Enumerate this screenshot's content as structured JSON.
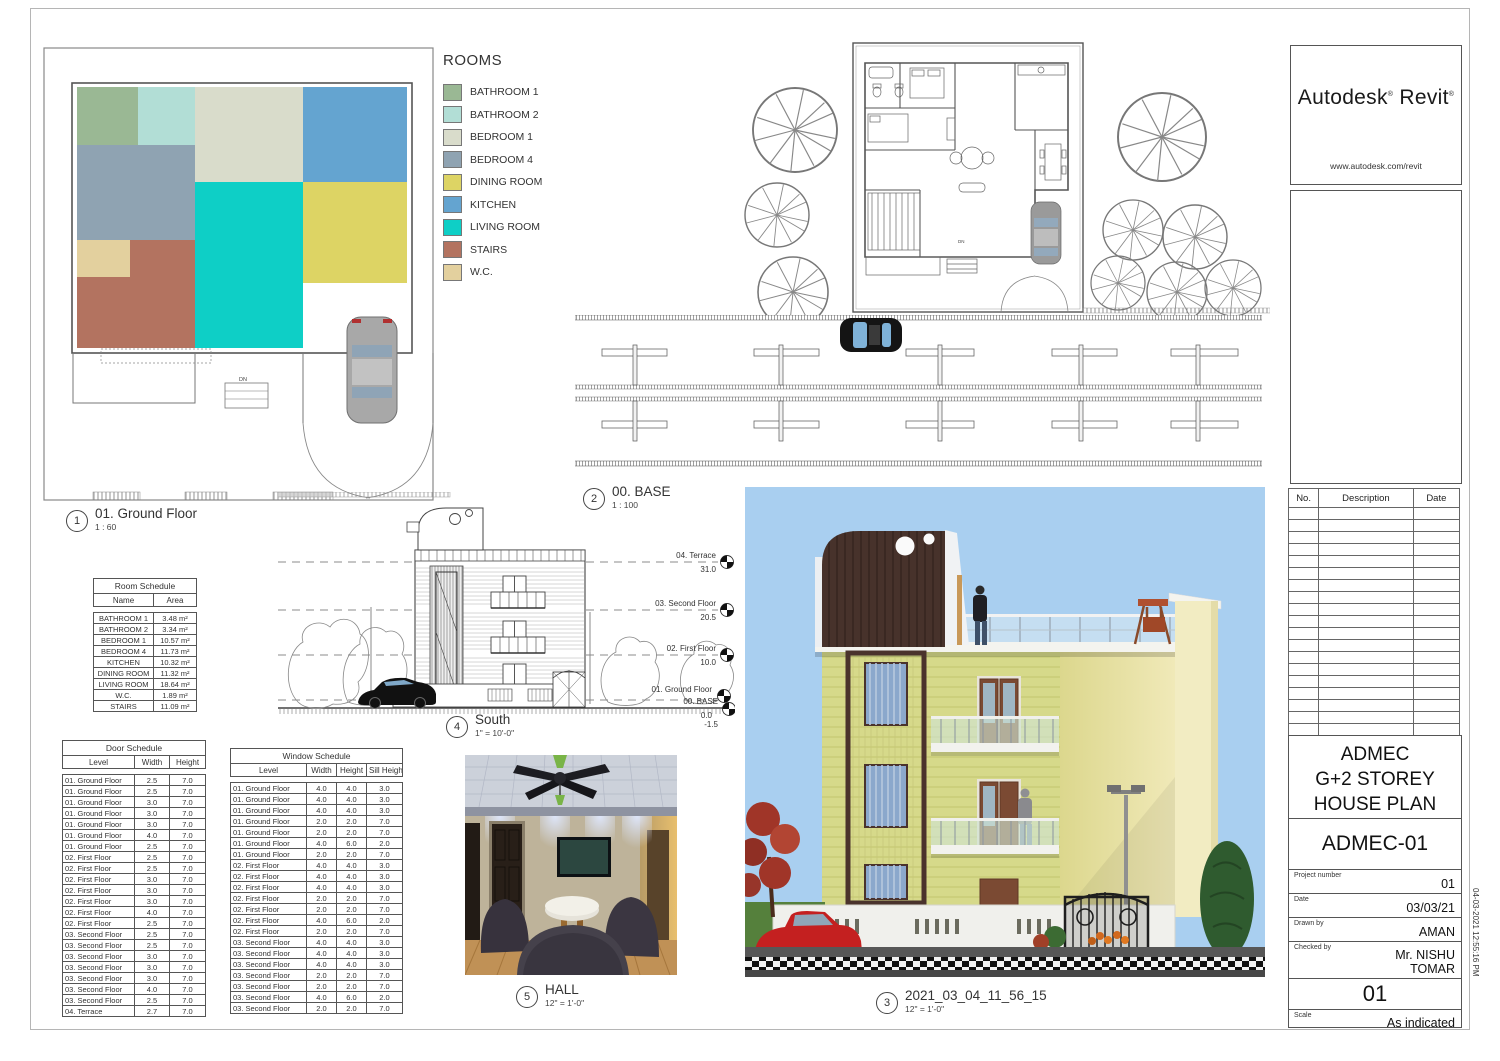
{
  "sheet": {
    "timestamp": "04-03-2021 12:55:16 PM"
  },
  "legend": {
    "title": "ROOMS",
    "items": [
      {
        "label": "BATHROOM 1",
        "color": "#9ab894"
      },
      {
        "label": "BATHROOM 2",
        "color": "#b2ded6"
      },
      {
        "label": "BEDROOM 1",
        "color": "#d9dccb"
      },
      {
        "label": "BEDROOM 4",
        "color": "#8fa3b2"
      },
      {
        "label": "DINING ROOM",
        "color": "#ddd464"
      },
      {
        "label": "KITCHEN",
        "color": "#64a4d0"
      },
      {
        "label": "LIVING ROOM",
        "color": "#0ecfc6"
      },
      {
        "label": "STAIRS",
        "color": "#b37360"
      },
      {
        "label": "W.C.",
        "color": "#e3d09e"
      }
    ]
  },
  "views": {
    "ground_floor": {
      "num": "1",
      "title": "01. Ground Floor",
      "scale": "1 : 60"
    },
    "base": {
      "num": "2",
      "title": "00. BASE",
      "scale": "1 : 100"
    },
    "render3d": {
      "num": "3",
      "title": "2021_03_04_11_56_15",
      "scale": "12\" = 1'-0\""
    },
    "south": {
      "num": "4",
      "title": "South",
      "scale": "1\" = 10'-0\""
    },
    "hall": {
      "num": "5",
      "title": "HALL",
      "scale": "12\" = 1'-0\""
    }
  },
  "levels": [
    {
      "name": "04. Terrace",
      "elev": "31.0"
    },
    {
      "name": "03. Second Floor",
      "elev": "20.5"
    },
    {
      "name": "02. First Floor",
      "elev": "10.0"
    },
    {
      "name": "01. Ground Floor",
      "elev": "0.0"
    },
    {
      "name": "00. BASE",
      "elev": "-1.5"
    }
  ],
  "misc": {
    "dn": "DN"
  },
  "room_schedule": {
    "title": "Room Schedule",
    "headers": [
      "Name",
      "Area"
    ],
    "rows": [
      [
        "BATHROOM 1",
        "3.48 m²"
      ],
      [
        "BATHROOM 2",
        "3.34 m²"
      ],
      [
        "BEDROOM 1",
        "10.57 m²"
      ],
      [
        "BEDROOM 4",
        "11.73 m²"
      ],
      [
        "KITCHEN",
        "10.32 m²"
      ],
      [
        "DINING ROOM",
        "11.32 m²"
      ],
      [
        "LIVING ROOM",
        "18.64 m²"
      ],
      [
        "W.C.",
        "1.89 m²"
      ],
      [
        "STAIRS",
        "11.09 m²"
      ]
    ]
  },
  "door_schedule": {
    "title": "Door Schedule",
    "headers": [
      "Level",
      "Width",
      "Height"
    ],
    "rows": [
      [
        "01. Ground Floor",
        "2.5",
        "7.0"
      ],
      [
        "01. Ground Floor",
        "2.5",
        "7.0"
      ],
      [
        "01. Ground Floor",
        "3.0",
        "7.0"
      ],
      [
        "01. Ground Floor",
        "3.0",
        "7.0"
      ],
      [
        "01. Ground Floor",
        "3.0",
        "7.0"
      ],
      [
        "01. Ground Floor",
        "4.0",
        "7.0"
      ],
      [
        "01. Ground Floor",
        "2.5",
        "7.0"
      ],
      [
        "02. First Floor",
        "2.5",
        "7.0"
      ],
      [
        "02. First Floor",
        "2.5",
        "7.0"
      ],
      [
        "02. First Floor",
        "3.0",
        "7.0"
      ],
      [
        "02. First Floor",
        "3.0",
        "7.0"
      ],
      [
        "02. First Floor",
        "3.0",
        "7.0"
      ],
      [
        "02. First Floor",
        "4.0",
        "7.0"
      ],
      [
        "02. First Floor",
        "2.5",
        "7.0"
      ],
      [
        "03. Second Floor",
        "2.5",
        "7.0"
      ],
      [
        "03. Second Floor",
        "2.5",
        "7.0"
      ],
      [
        "03. Second Floor",
        "3.0",
        "7.0"
      ],
      [
        "03. Second Floor",
        "3.0",
        "7.0"
      ],
      [
        "03. Second Floor",
        "3.0",
        "7.0"
      ],
      [
        "03. Second Floor",
        "4.0",
        "7.0"
      ],
      [
        "03. Second Floor",
        "2.5",
        "7.0"
      ],
      [
        "04. Terrace",
        "2.7",
        "7.0"
      ]
    ]
  },
  "window_schedule": {
    "title": "Window Schedule",
    "headers": [
      "Level",
      "Width",
      "Height",
      "Sill Height"
    ],
    "rows": [
      [
        "01. Ground Floor",
        "4.0",
        "4.0",
        "3.0"
      ],
      [
        "01. Ground Floor",
        "4.0",
        "4.0",
        "3.0"
      ],
      [
        "01. Ground Floor",
        "4.0",
        "4.0",
        "3.0"
      ],
      [
        "01. Ground Floor",
        "2.0",
        "2.0",
        "7.0"
      ],
      [
        "01. Ground Floor",
        "2.0",
        "2.0",
        "7.0"
      ],
      [
        "01. Ground Floor",
        "4.0",
        "6.0",
        "2.0"
      ],
      [
        "01. Ground Floor",
        "2.0",
        "2.0",
        "7.0"
      ],
      [
        "02. First Floor",
        "4.0",
        "4.0",
        "3.0"
      ],
      [
        "02. First Floor",
        "4.0",
        "4.0",
        "3.0"
      ],
      [
        "02. First Floor",
        "4.0",
        "4.0",
        "3.0"
      ],
      [
        "02. First Floor",
        "2.0",
        "2.0",
        "7.0"
      ],
      [
        "02. First Floor",
        "2.0",
        "2.0",
        "7.0"
      ],
      [
        "02. First Floor",
        "4.0",
        "6.0",
        "2.0"
      ],
      [
        "02. First Floor",
        "2.0",
        "2.0",
        "7.0"
      ],
      [
        "03. Second Floor",
        "4.0",
        "4.0",
        "3.0"
      ],
      [
        "03. Second Floor",
        "4.0",
        "4.0",
        "3.0"
      ],
      [
        "03. Second Floor",
        "4.0",
        "4.0",
        "3.0"
      ],
      [
        "03. Second Floor",
        "2.0",
        "2.0",
        "7.0"
      ],
      [
        "03. Second Floor",
        "2.0",
        "2.0",
        "7.0"
      ],
      [
        "03. Second Floor",
        "4.0",
        "6.0",
        "2.0"
      ],
      [
        "03. Second Floor",
        "2.0",
        "2.0",
        "7.0"
      ]
    ]
  },
  "titleblock": {
    "brand_word1": "Autodesk",
    "brand_word2": "Revit",
    "reg": "®",
    "url": "www.autodesk.com/revit",
    "revisions": {
      "headers": [
        "No.",
        "Description",
        "Date"
      ],
      "empty_rows": 23
    },
    "title_lines": [
      "ADMEC",
      "G+2 STOREY",
      "HOUSE PLAN"
    ],
    "drawing_no": "ADMEC-01",
    "fields": [
      {
        "label": "Project number",
        "value": "01"
      },
      {
        "label": "Date",
        "value": "03/03/21"
      },
      {
        "label": "Drawn by",
        "value": "AMAN"
      },
      {
        "label": "Checked by",
        "value": "Mr. NISHU TOMAR"
      }
    ],
    "sheet_number": "01",
    "scale_label": "Scale",
    "scale_value": "As indicated"
  }
}
